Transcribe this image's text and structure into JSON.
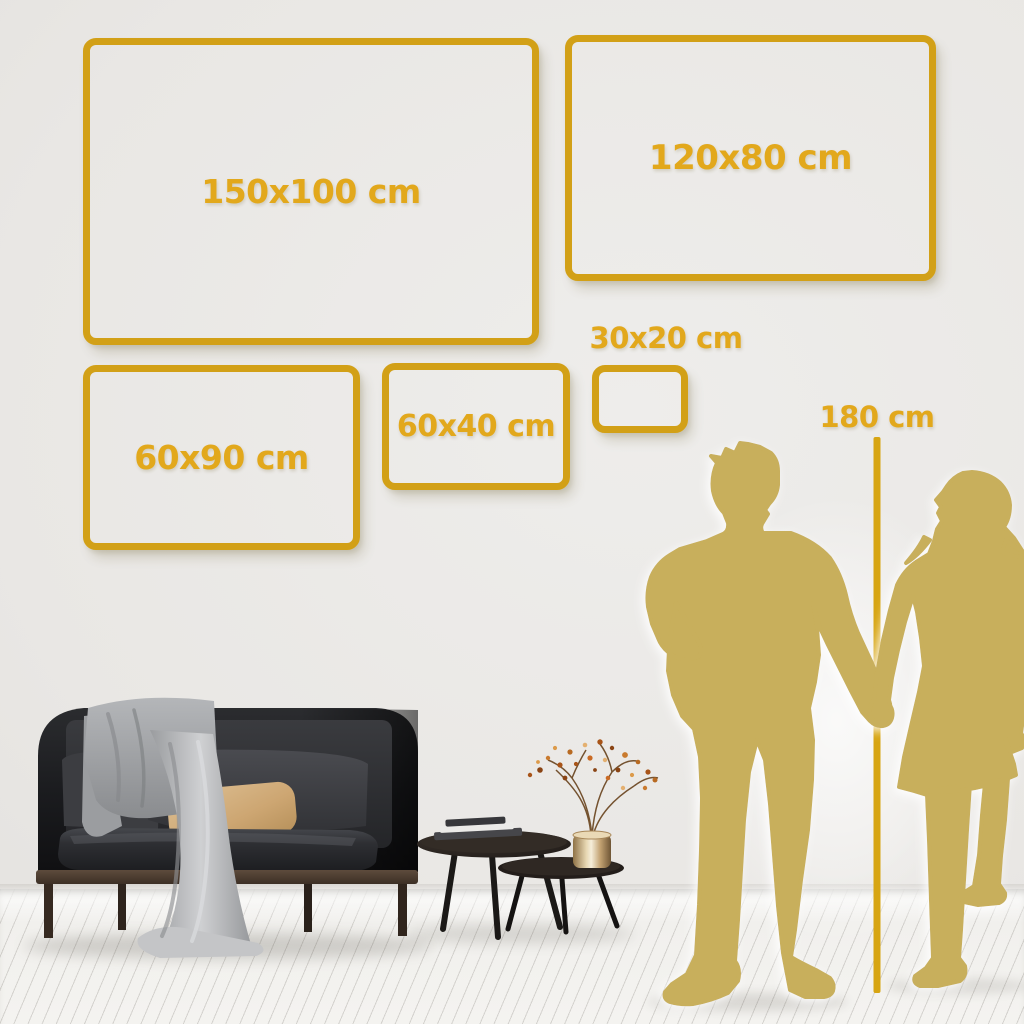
{
  "frames": [
    {
      "id": "150x100",
      "label": "150x100 cm"
    },
    {
      "id": "120x80",
      "label": "120x80 cm"
    },
    {
      "id": "60x90",
      "label": "60x90 cm"
    },
    {
      "id": "60x40",
      "label": "60x40 cm"
    },
    {
      "id": "30x20",
      "label": "30x20 cm"
    }
  ],
  "height_marker": {
    "label": "180 cm"
  },
  "colors": {
    "frame_gold": "#D2A017",
    "label_gold": "#E2A81C",
    "measure_line_gold": "#D7A512",
    "silhouette_gold": "#C8AF5B",
    "wall": "#E9E7E4",
    "floor": "#F2F1EE"
  }
}
